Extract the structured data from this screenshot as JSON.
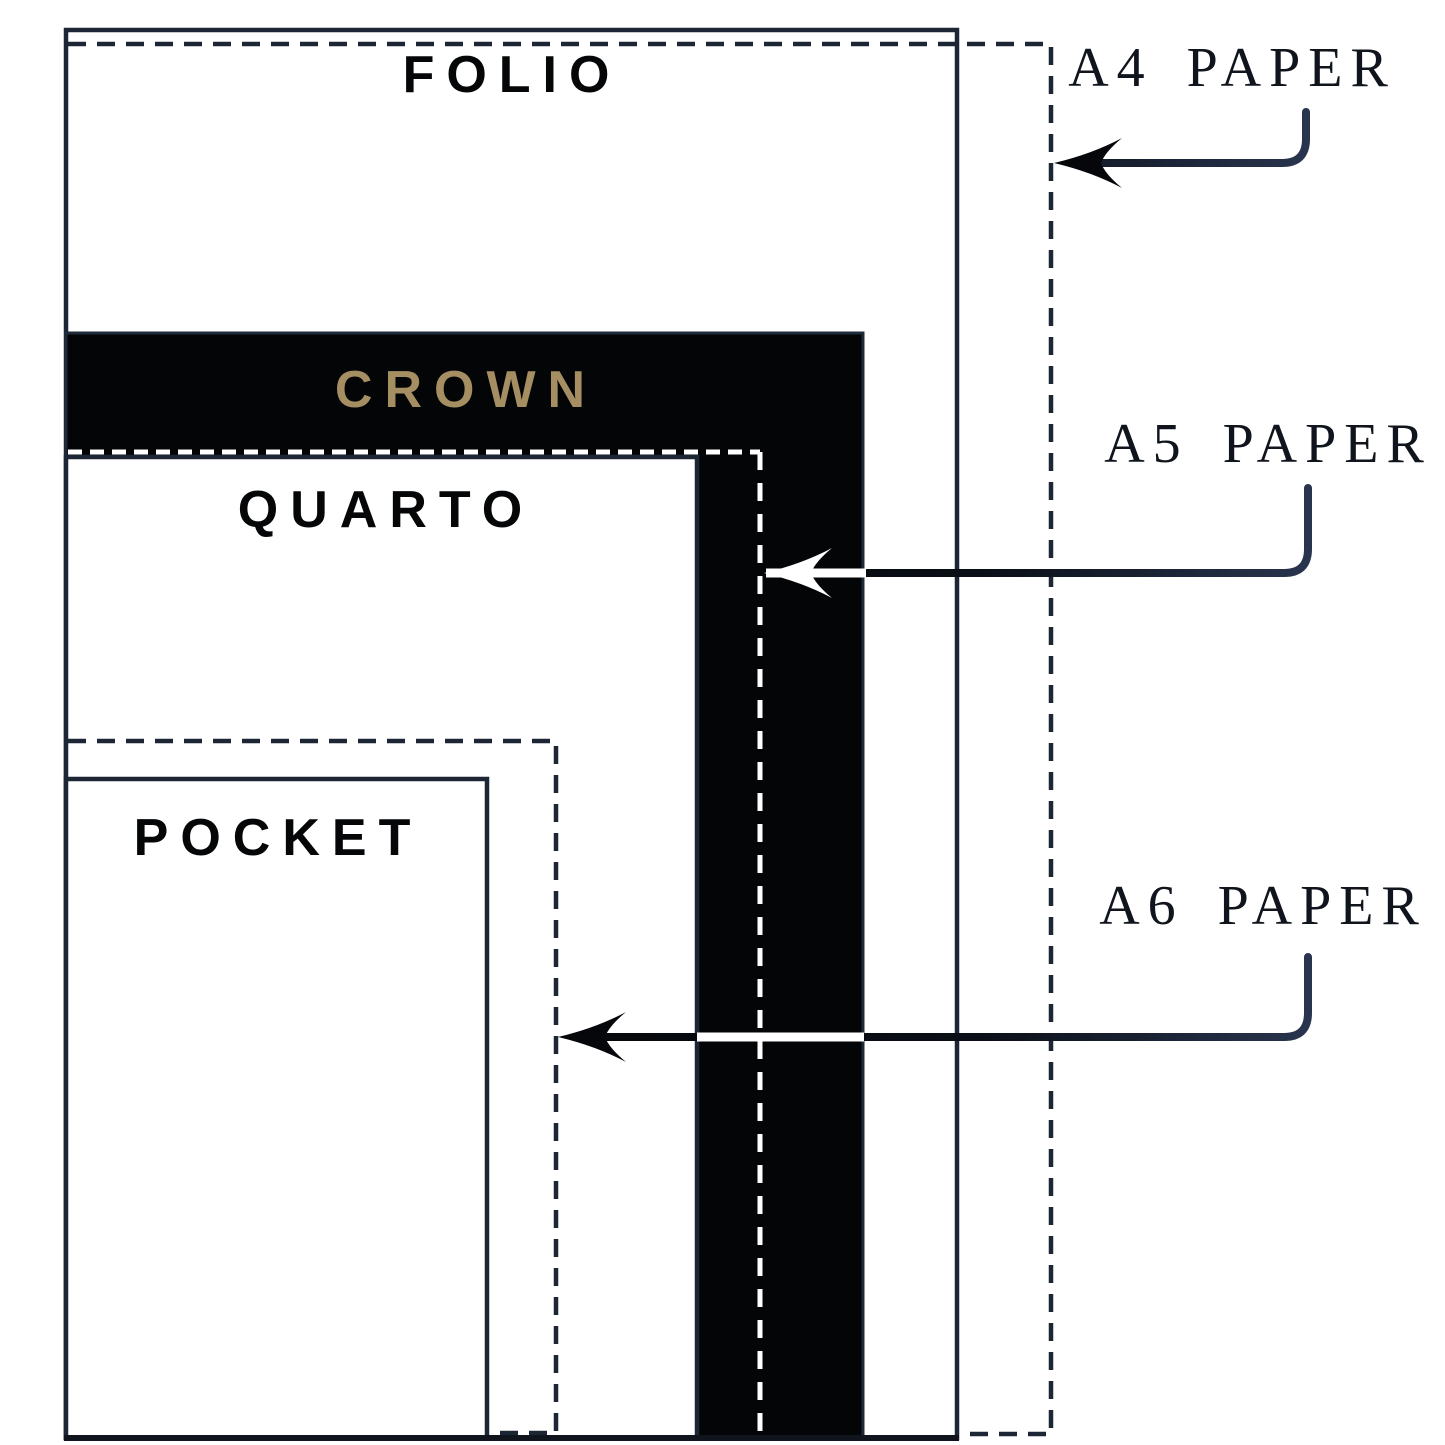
{
  "notebooks": [
    {
      "id": "folio",
      "label": "FOLIO",
      "fill": "white"
    },
    {
      "id": "crown",
      "label": "CROWN",
      "fill": "black"
    },
    {
      "id": "quarto",
      "label": "QUARTO",
      "fill": "white"
    },
    {
      "id": "pocket",
      "label": "POCKET",
      "fill": "white"
    }
  ],
  "papers": [
    {
      "id": "a4",
      "label": "A4 PAPER",
      "outline": "dashed-dark"
    },
    {
      "id": "a5",
      "label": "A5 PAPER",
      "outline": "dashed-white"
    },
    {
      "id": "a6",
      "label": "A6 PAPER",
      "outline": "dashed-dark"
    }
  ],
  "colors": {
    "background": "#ffffff",
    "line": "#1d2634",
    "crown_fill": "#040507",
    "crown_label": "#a68e63",
    "notebook_label": "#050607",
    "paper_label": "#10141c",
    "arrow_dark": "#05070a",
    "arrow_navy": "#2a3650"
  }
}
